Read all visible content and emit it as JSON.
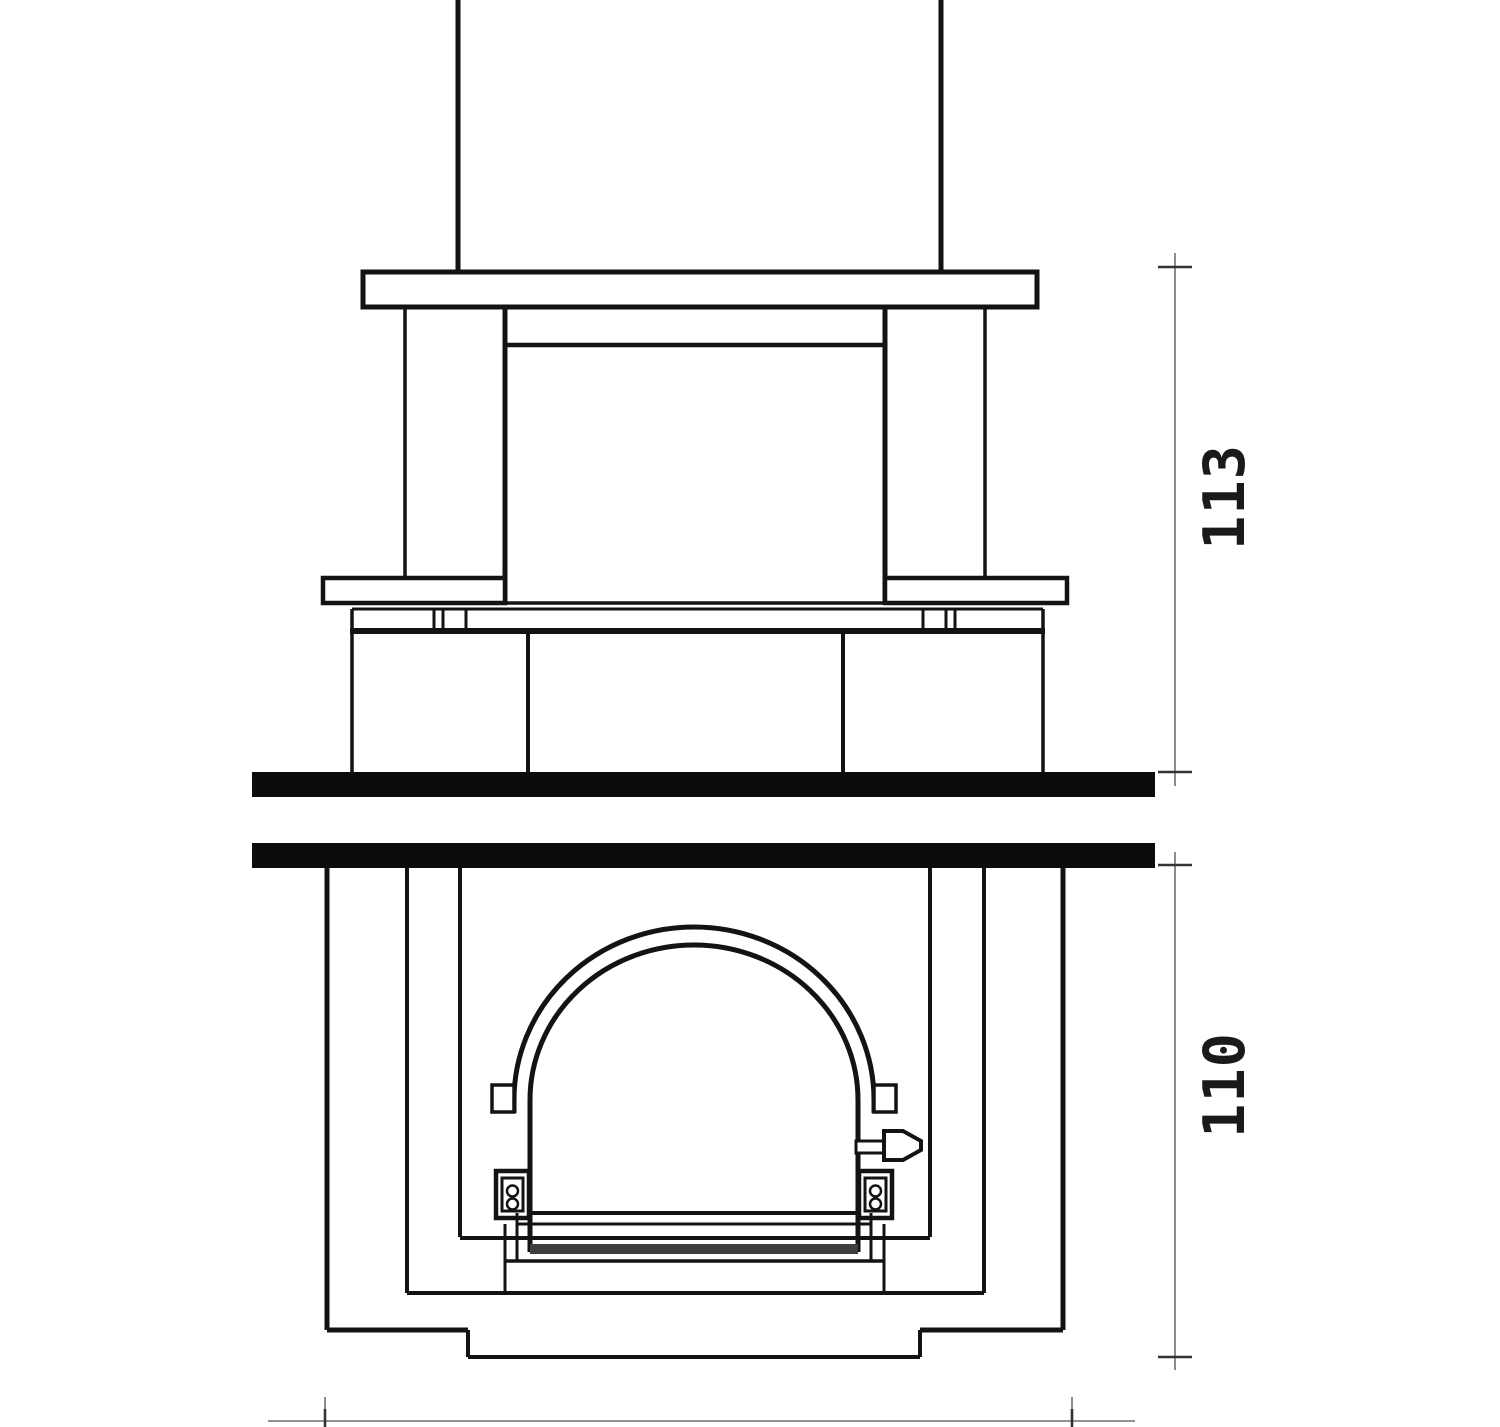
{
  "drawing": {
    "kind": "fireplace-front-elevation-two-views",
    "dimensions": {
      "upper": {
        "label": "113",
        "orientation": "vertical",
        "side": "right"
      },
      "lower": {
        "label": "110",
        "orientation": "vertical",
        "side": "right"
      }
    },
    "parts": {
      "upper_view": [
        "flue-pipe",
        "cap-slab",
        "pillars",
        "firebox",
        "lintel",
        "mantel-shelves",
        "base-blocks",
        "floor-slab"
      ],
      "lower_view": [
        "ceiling-slab",
        "nested-casing-frames",
        "arched-door",
        "door-hinges",
        "latch-handle",
        "sill",
        "plinth"
      ]
    },
    "colors": {
      "ink": "#131313",
      "slab_fill": "#0c0c0c",
      "dimension_line": "#6f6f6f",
      "dimension_tick": "#333333",
      "dimension_text": "#1a1a1a",
      "sill_shade": "#3f3f3f",
      "background": "#ffffff"
    }
  }
}
